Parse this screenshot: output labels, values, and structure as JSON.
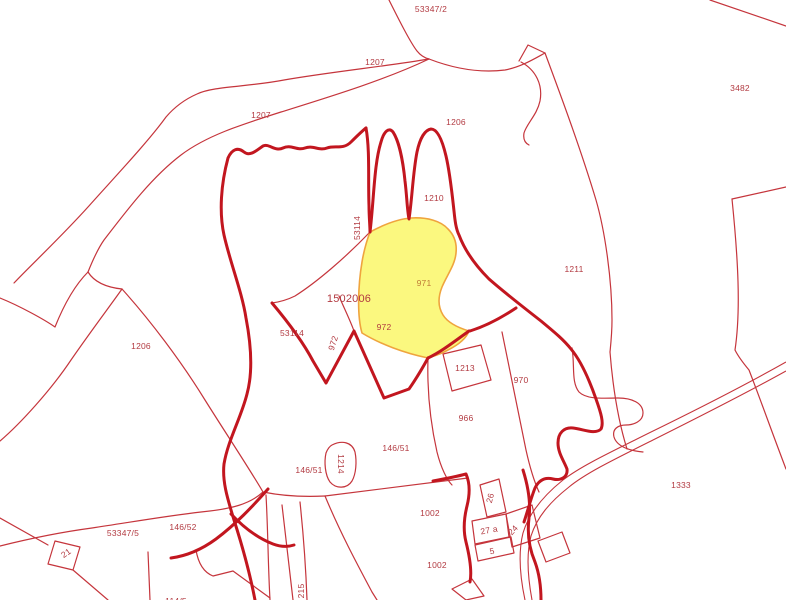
{
  "map": {
    "type": "cadastral-parcel-map",
    "background": "#ffffff",
    "colors": {
      "parcel_line": "#c5353c",
      "boundary_line": "#c2161f",
      "highlight_fill": "#fbf87f",
      "highlight_border": "#efa43e",
      "label": "#b23a41",
      "highlight_label": "#bf7b36"
    },
    "highlighted_parcel": "971",
    "labels": [
      {
        "text": "53347/2"
      },
      {
        "text": "1207"
      },
      {
        "text": "1207"
      },
      {
        "text": "1206"
      },
      {
        "text": "3482"
      },
      {
        "text": "1210"
      },
      {
        "text": "53114"
      },
      {
        "text": "971"
      },
      {
        "text": "1211"
      },
      {
        "text": "1502006"
      },
      {
        "text": "972"
      },
      {
        "text": "972"
      },
      {
        "text": "53114"
      },
      {
        "text": "1206"
      },
      {
        "text": "1213"
      },
      {
        "text": "970"
      },
      {
        "text": "966"
      },
      {
        "text": "146/51"
      },
      {
        "text": "1214"
      },
      {
        "text": "146/51"
      },
      {
        "text": "1333"
      },
      {
        "text": "146/52"
      },
      {
        "text": "53347/5"
      },
      {
        "text": "21"
      },
      {
        "text": "1002"
      },
      {
        "text": "26"
      },
      {
        "text": "27 a"
      },
      {
        "text": "24"
      },
      {
        "text": "5"
      },
      {
        "text": "1002"
      },
      {
        "text": "215"
      },
      {
        "text": "114/5"
      }
    ]
  }
}
